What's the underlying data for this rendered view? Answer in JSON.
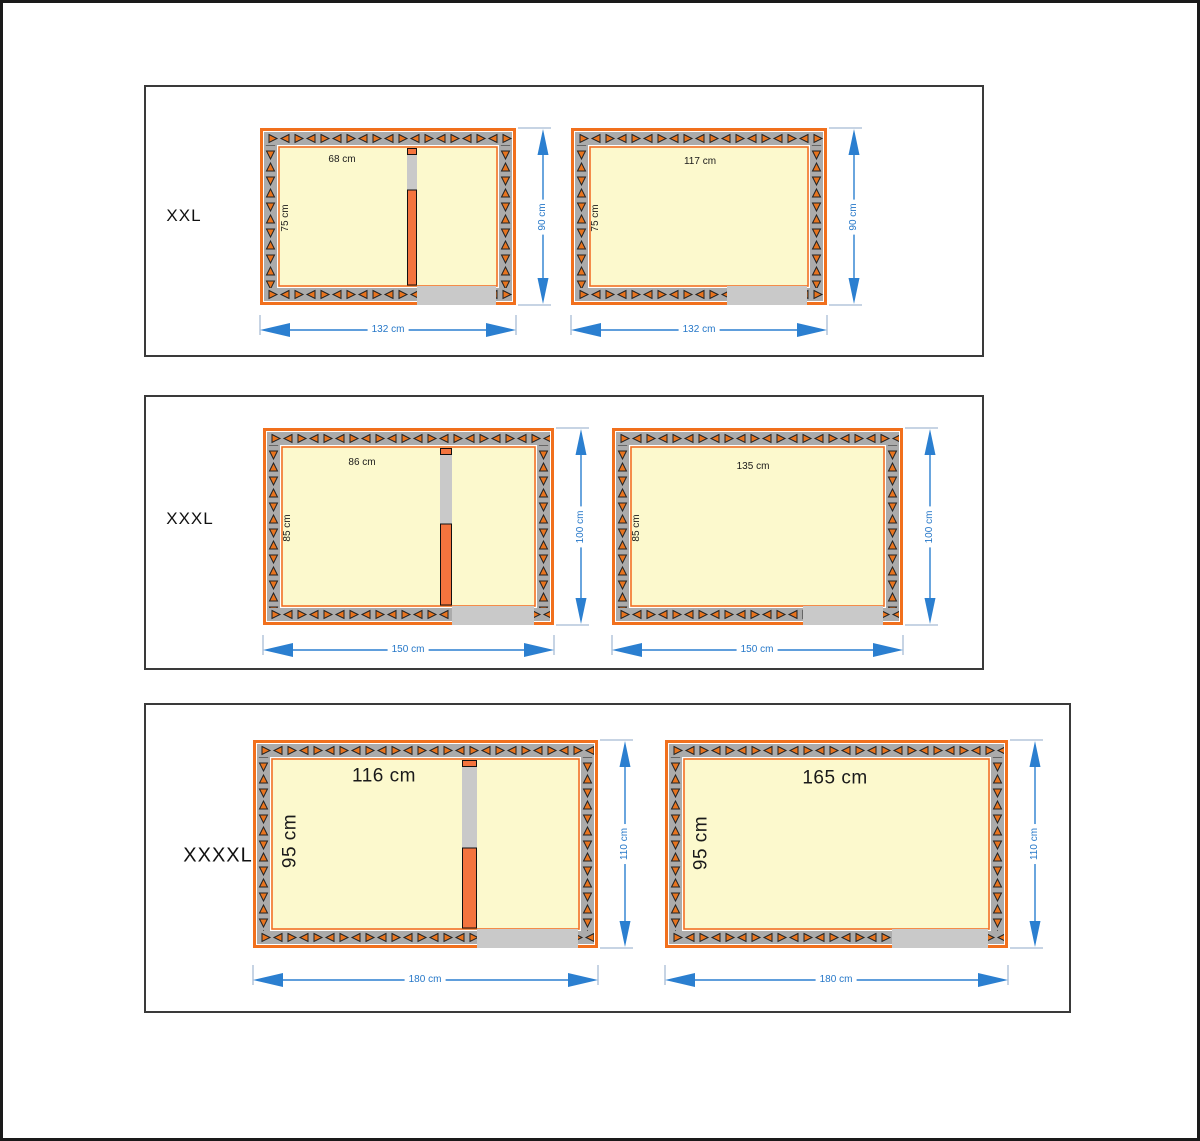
{
  "sheet": {
    "unit": "cm",
    "description_labels": {
      "panel_1": "XXL",
      "panel_2": "XXXL",
      "panel_3": "XXXXL"
    }
  },
  "colors": {
    "page_bg": "#ffffff",
    "frame": "#1a1a1a",
    "panel_border": "#3a3a3a",
    "wall_orange": "#f1701d",
    "divider_orange": "#f4743e",
    "hatch_orange": "#e8741e",
    "interior_yellow": "#fcf9cd",
    "wall_gray": "#ababab",
    "door_gray": "#c9c9c9",
    "dim_blue": "#2b7fd0",
    "tick_blue": "#8fa9c9",
    "label_black": "#1a1a1a"
  },
  "panels": [
    {
      "label": "XXL",
      "rooms": [
        {
          "variant": "two-chamber",
          "inner_width": "68 cm",
          "inner_height": "75 cm",
          "outer_width": "132 cm",
          "outer_height": "90 cm"
        },
        {
          "variant": "single-chamber",
          "inner_width": "117 cm",
          "inner_height": "75 cm",
          "outer_width": "132 cm",
          "outer_height": "90 cm"
        }
      ]
    },
    {
      "label": "XXXL",
      "rooms": [
        {
          "variant": "two-chamber",
          "inner_width": "86 cm",
          "inner_height": "85 cm",
          "outer_width": "150 cm",
          "outer_height": "100 cm"
        },
        {
          "variant": "single-chamber",
          "inner_width": "135 cm",
          "inner_height": "85 cm",
          "outer_width": "150 cm",
          "outer_height": "100 cm"
        }
      ]
    },
    {
      "label": "XXXXL",
      "rooms": [
        {
          "variant": "two-chamber",
          "inner_width": "116 cm",
          "inner_height": "95 cm",
          "outer_width": "180 cm",
          "outer_height": "110 cm"
        },
        {
          "variant": "single-chamber",
          "inner_width": "165 cm",
          "inner_height": "95 cm",
          "outer_width": "180 cm",
          "outer_height": "110 cm"
        }
      ]
    }
  ]
}
